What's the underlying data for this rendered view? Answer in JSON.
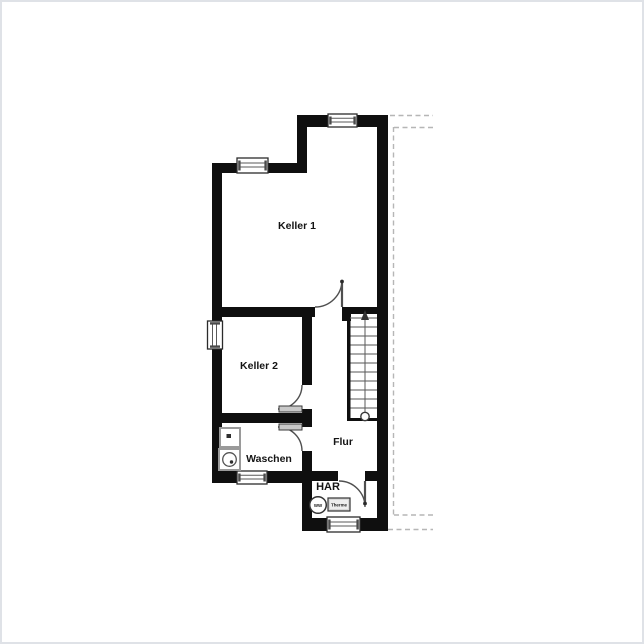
{
  "plan": {
    "type": "floor-plan",
    "rooms": [
      {
        "label": "Keller 1"
      },
      {
        "label": "Keller 2"
      },
      {
        "label": "Flur"
      },
      {
        "label": "Waschen"
      },
      {
        "label": "HAR"
      }
    ],
    "equipment": {
      "ww_label": "WW",
      "therme_label": "Therme"
    },
    "stairs": {
      "steps": 11,
      "direction": "up"
    },
    "counts": {
      "windows": 5,
      "doors": 4
    },
    "colors": {
      "wall": "#0f0f0f",
      "background": "#ffffff",
      "stair_tread": "#8d8d8d",
      "door_swing": "#4f4f4f",
      "dashed_boundary": "#b6b6b6",
      "frame_border": "#dfe2e7",
      "fixture_gray": "#9a9a9a"
    }
  }
}
